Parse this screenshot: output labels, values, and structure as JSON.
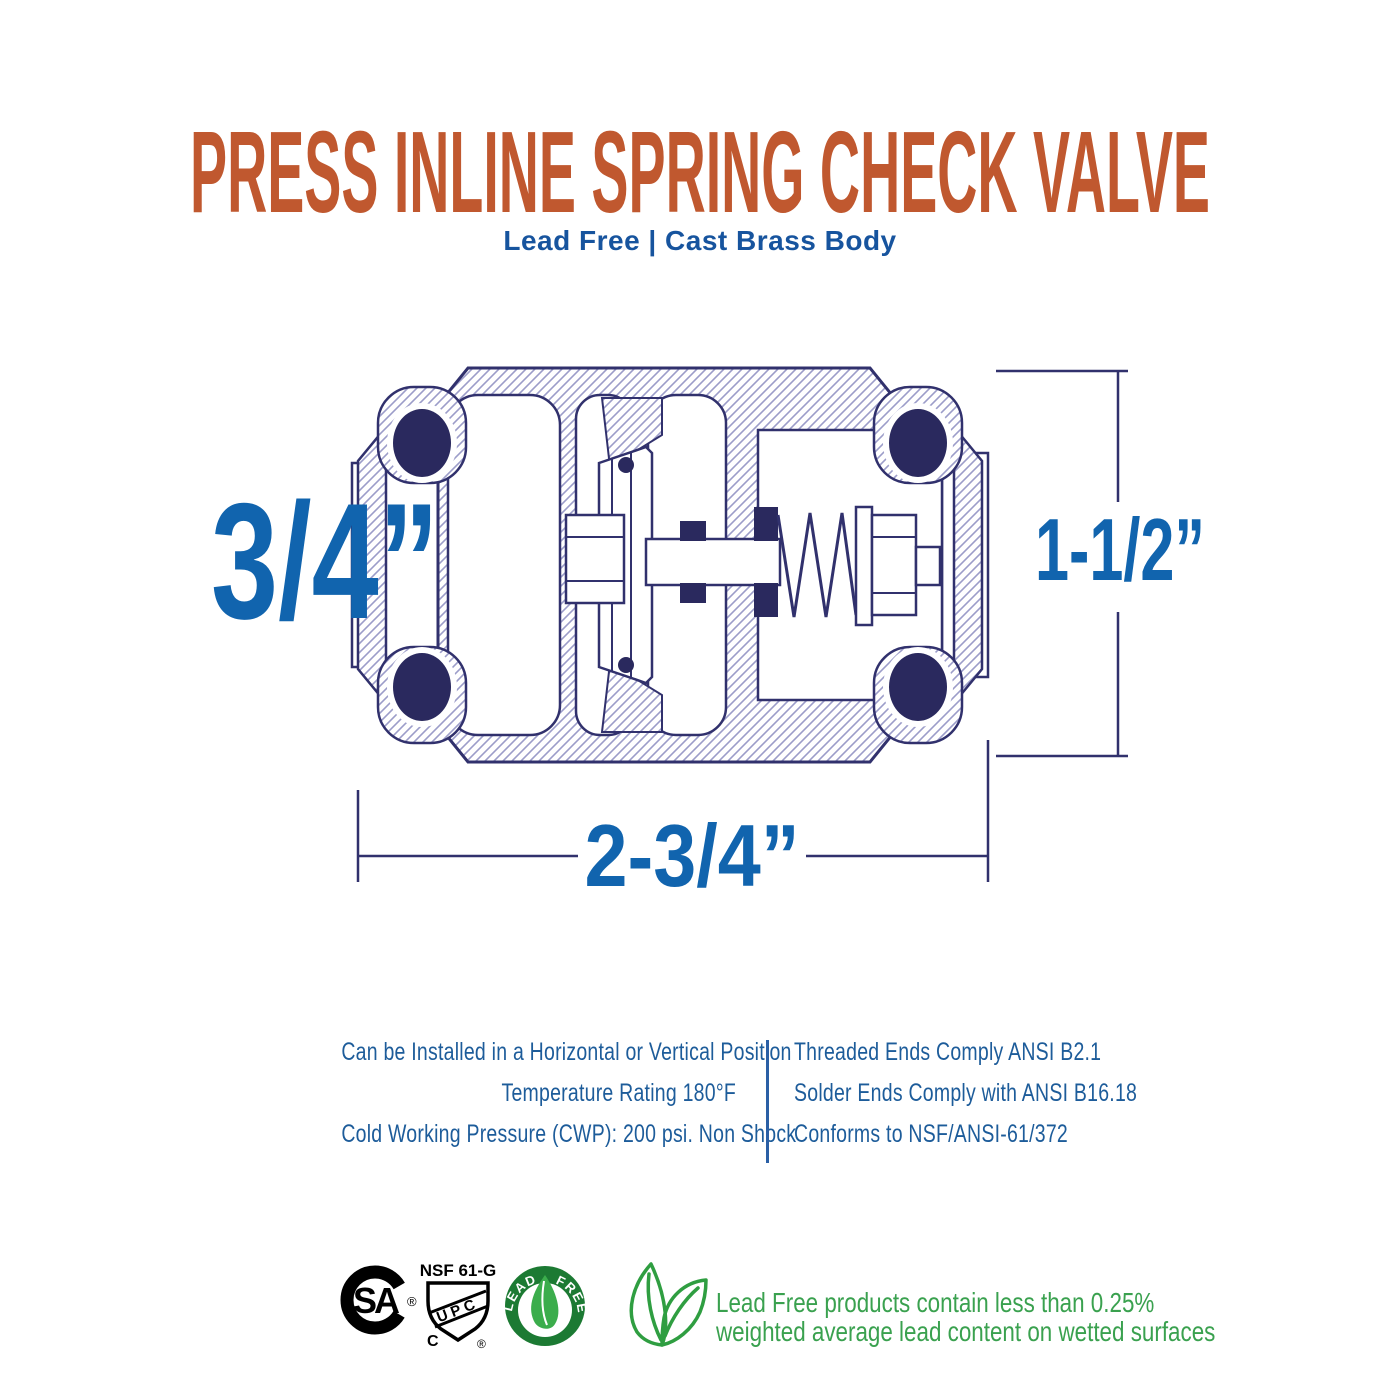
{
  "header": {
    "title": "PRESS INLINE SPRING CHECK VALVE",
    "subtitle": "Lead Free  |  Cast Brass Body"
  },
  "diagram": {
    "dim_inlet": "3/4”",
    "dim_height": "1-1/2”",
    "dim_length": "2-3/4”"
  },
  "specs": {
    "left": [
      "Can be Installed in a Horizontal or Vertical Position",
      "Temperature Rating 180°F",
      "Cold Working Pressure (CWP): 200 psi. Non Shock"
    ],
    "right": [
      "Threaded Ends Comply ANSI B2.1",
      "Solder Ends Comply with ANSI B16.18",
      "Conforms to NSF/ANSI-61/372"
    ]
  },
  "certifications": {
    "csa": {
      "letters": "SA",
      "registered": "®"
    },
    "upc": {
      "top_label": "NSF 61-G",
      "letters": "UPC",
      "bottom_left": "C",
      "registered": "®"
    },
    "lead_free_badge": {
      "arc_left": "LEAD",
      "arc_right": "FREE"
    },
    "note_line1": "Lead Free products contain less than 0.25%",
    "note_line2": "weighted average lead content on wetted surfaces"
  },
  "colors": {
    "accent_orange": "#c0582f",
    "heading_blue": "#17549e",
    "dimension_blue": "#1164ae",
    "spec_blue": "#1d5c9a",
    "drawing_navy": "#31316d",
    "oring_navy": "#2a295e",
    "cert_green": "#1c7a33",
    "leaf_green": "#3bad4c",
    "note_green": "#3aa14f"
  }
}
